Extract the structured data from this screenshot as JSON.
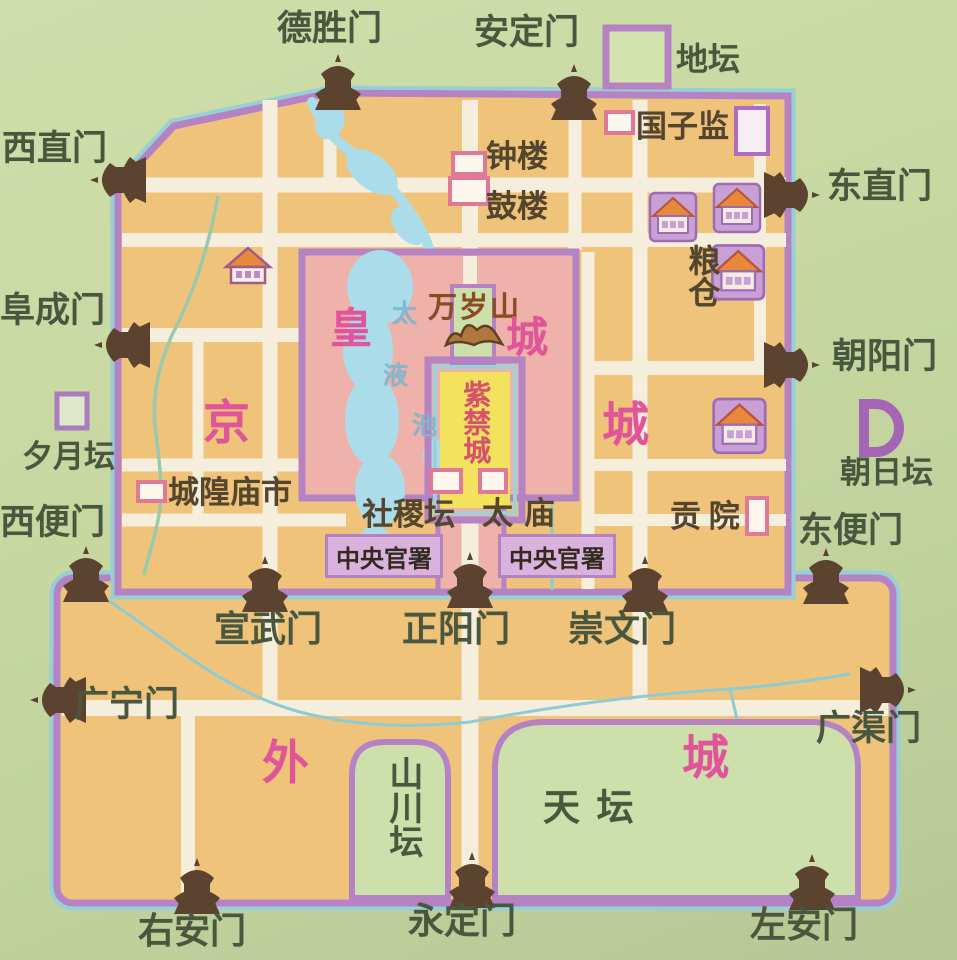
{
  "legend": {
    "ditan_label": "地坛"
  },
  "gates": {
    "deshengmen": "德胜门",
    "andingmen": "安定门",
    "xizhimen": "西直门",
    "dongzhimen": "东直门",
    "fuchengmen": "阜成门",
    "chaoyangmen": "朝阳门",
    "xibianmen": "西便门",
    "dongbianmen": "东便门",
    "xuanwumen": "宣武门",
    "zhengyangmen": "正阳门",
    "chongwenmen": "崇文门",
    "guangningmen": "广宁门",
    "guangqumen": "广渠门",
    "youanmen": "右安门",
    "yongdingmen": "永定门",
    "zuoanmen": "左安门"
  },
  "altars": {
    "xiyuetan": "夕月坛",
    "chaoritan": "朝日坛",
    "shejitan": "社稷坛",
    "tiantan": "天坛",
    "shanchuantan": "山川坛"
  },
  "sites": {
    "guozijian": "国子监",
    "bell_tower": "钟楼",
    "drum_tower": "鼓楼",
    "granary": "粮仓",
    "chenghuang_market": "城隍庙市",
    "taimiao": "太庙",
    "gongyuan": "贡院",
    "central_offices_west": "中央官署",
    "central_offices_east": "中央官署"
  },
  "regions": {
    "jing": "京",
    "cheng_east": "城",
    "huang": "皇",
    "cheng_ne": "城",
    "wai": "外",
    "cheng_se": "城",
    "forbidden_city": "紫禁城",
    "wansuishan": "万岁山",
    "taiye_tai": "太",
    "taiye_ye": "液",
    "taiye_chi": "池"
  },
  "colors": {
    "background_green": "#c6d7a0",
    "city_fill": "#f0c37b",
    "road_cream": "#f6eedd",
    "wall_purple": "#b583c4",
    "wall_outline_teal": "#96d0d6",
    "imperial_pink": "#eeb2aa",
    "water_blue": "#abdcea",
    "forbidden_yellow": "#f2e25e",
    "enclosure_green": "#cde0ab",
    "label_pink": "#e0559a",
    "label_green": "#49573f",
    "label_brown": "#53452e",
    "forbidden_text_red": "#d8506e",
    "gate_icon_brown": "#5c4330",
    "granary_purple": "#c9a0d6",
    "roof_orange": "#e8883a"
  }
}
